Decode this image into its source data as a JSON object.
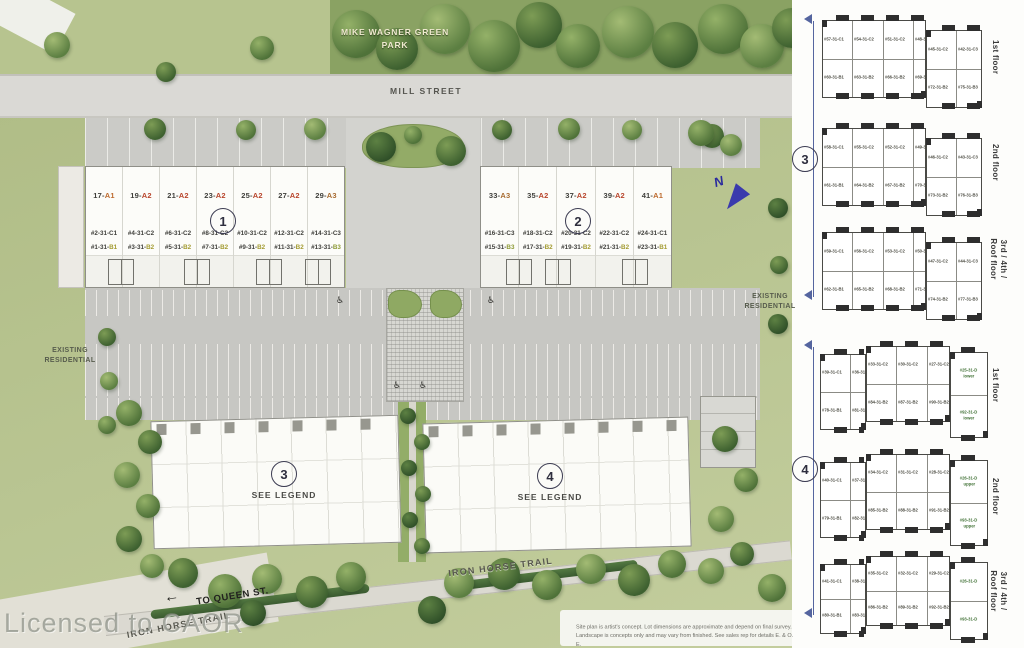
{
  "colors": {
    "site_green": "#b6c28d",
    "road_gray": "#dad9d5",
    "parking_gray": "#c7c7c3",
    "building_white": "#fcfcf9",
    "bracket_blue": "#55659f",
    "north_blue": "#3a3aad",
    "code_orange_a1": "#bd6a2e",
    "code_red_a2": "#b8452c",
    "code_brown_a3": "#a76b31",
    "code_olive_b": "#a39b31",
    "code_green_d": "#3f7034"
  },
  "site": {
    "park_label_1": "MIKE WAGNER GREEN",
    "park_label_2": "PARK",
    "street_label": "MILL STREET",
    "existing_left_1": "EXISTING",
    "existing_left_2": "RESIDENTIAL",
    "existing_right_1": "EXISTING",
    "existing_right_2": "RESIDENTIAL",
    "trail_label_1": "IRON HORSE TRAIL",
    "trail_label_2": "IRON HORSE TRAIL",
    "queen_arrow": "←",
    "queen_label": "TO QUEEN ST.",
    "north_label": "N",
    "watermark": "Licensed to CAOR",
    "see_legend_3": "SEE LEGEND",
    "see_legend_4": "SEE LEGEND",
    "wheelchair_icon": "♿",
    "disclaimer_1": "Site plan is artist's concept. Lot dimensions are approximate and depend on final survey.",
    "disclaimer_2": "Landscape is concepts only and may vary from finished. See sales rep for details E. & O. E.",
    "b1": {
      "num": "1",
      "units": [
        {
          "sn": "17-",
          "st": "A1",
          "sts": "color:#bd6a2e",
          "c1": "#2-31-C1",
          "c2a": "#1-31-",
          "c2b": "B1",
          "c2s": "color:#a39b31"
        },
        {
          "sn": "19-",
          "st": "A2",
          "sts": "color:#b8452c",
          "c1": "#4-31-C2",
          "c2a": "#3-31-",
          "c2b": "B2",
          "c2s": "color:#a39b31"
        },
        {
          "sn": "21-",
          "st": "A2",
          "sts": "color:#b8452c",
          "c1": "#6-31-C2",
          "c2a": "#5-31-",
          "c2b": "B2",
          "c2s": "color:#a39b31"
        },
        {
          "sn": "23-",
          "st": "A2",
          "sts": "color:#b8452c",
          "c1": "#8-31-C2",
          "c2a": "#7-31-",
          "c2b": "B2",
          "c2s": "color:#a39b31"
        },
        {
          "sn": "25-",
          "st": "A2",
          "sts": "color:#b8452c",
          "c1": "#10-31-C2",
          "c2a": "#9-31-",
          "c2b": "B2",
          "c2s": "color:#a39b31"
        },
        {
          "sn": "27-",
          "st": "A2",
          "sts": "color:#b8452c",
          "c1": "#12-31-C2",
          "c2a": "#11-31-",
          "c2b": "B2",
          "c2s": "color:#a39b31"
        },
        {
          "sn": "29-",
          "st": "A3",
          "sts": "color:#a76b31",
          "c1": "#14-31-C3",
          "c2a": "#13-31-",
          "c2b": "B3",
          "c2s": "color:#8d9a36"
        }
      ]
    },
    "b2": {
      "num": "2",
      "units": [
        {
          "sn": "33-",
          "st": "A3",
          "sts": "color:#a76b31",
          "c1": "#16-31-C3",
          "c2a": "#15-31-",
          "c2b": "B3",
          "c2s": "color:#8d9a36"
        },
        {
          "sn": "35-",
          "st": "A2",
          "sts": "color:#b8452c",
          "c1": "#18-31-C2",
          "c2a": "#17-31-",
          "c2b": "B2",
          "c2s": "color:#a39b31"
        },
        {
          "sn": "37-",
          "st": "A2",
          "sts": "color:#b8452c",
          "c1": "#20-31-C2",
          "c2a": "#19-31-",
          "c2b": "B2",
          "c2s": "color:#a39b31"
        },
        {
          "sn": "39-",
          "st": "A2",
          "sts": "color:#b8452c",
          "c1": "#22-31-C2",
          "c2a": "#21-31-",
          "c2b": "B2",
          "c2s": "color:#a39b31"
        },
        {
          "sn": "41-",
          "st": "A1",
          "sts": "color:#bd6a2e",
          "c1": "#24-31-C1",
          "c2a": "#23-31-",
          "c2b": "B1",
          "c2s": "color:#a39b31"
        }
      ]
    },
    "b3": {
      "num": "3"
    },
    "b4": {
      "num": "4"
    }
  },
  "legend": {
    "floors": [
      "1st floor",
      "2nd floor",
      "3rd / 4th / Roof floor"
    ],
    "g3": {
      "num": "3",
      "plans": [
        {
          "mt": [
            "#57-31-C1",
            "#54-31-C2",
            "#51-31-C2",
            "#48-31-C2"
          ],
          "mb": [
            "#60-31-B1",
            "#63-31-B2",
            "#66-31-B2",
            "#69-31-B2"
          ],
          "rt": [
            "#45-31-C2",
            "#42-31-C3"
          ],
          "rb": [
            "#72-31-B2",
            "#75-31-B3"
          ]
        },
        {
          "mt": [
            "#58-31-C1",
            "#55-31-C2",
            "#52-31-C2",
            "#49-31-C2"
          ],
          "mb": [
            "#61-31-B1",
            "#64-31-B2",
            "#67-31-B2",
            "#70-31-B2"
          ],
          "rt": [
            "#46-31-C2",
            "#43-31-C3"
          ],
          "rb": [
            "#73-31-B2",
            "#76-31-B3"
          ]
        },
        {
          "mt": [
            "#59-31-C1",
            "#56-31-C2",
            "#53-31-C2",
            "#50-31-C2"
          ],
          "mb": [
            "#62-31-B1",
            "#65-31-B2",
            "#68-31-B2",
            "#71-31-B2"
          ],
          "rt": [
            "#47-31-C2",
            "#44-31-C3"
          ],
          "rb": [
            "#74-31-B2",
            "#77-31-B3"
          ]
        }
      ]
    },
    "g4": {
      "num": "4",
      "plans": [
        {
          "lt": [
            "#39-31-C1",
            "#36-31-C2"
          ],
          "lb": [
            "#78-31-B1",
            "#81-31-B2"
          ],
          "mt": [
            "#33-31-C2",
            "#30-31-C2",
            "#27-31-C2"
          ],
          "mb": [
            "#84-31-B2",
            "#87-31-B2",
            "#90-31-B2"
          ],
          "rt": [
            {
              "t": "#25-31-D",
              "sub": "lower"
            }
          ],
          "rb": [
            {
              "t": "#92-31-D",
              "sub": "lower"
            }
          ]
        },
        {
          "lt": [
            "#40-31-C1",
            "#37-31-C2"
          ],
          "lb": [
            "#79-31-B1",
            "#82-31-B2"
          ],
          "mt": [
            "#34-31-C2",
            "#31-31-C2",
            "#28-31-C2"
          ],
          "mb": [
            "#85-31-B2",
            "#88-31-B2",
            "#91-31-B2"
          ],
          "rt": [
            {
              "t": "#26-31-D",
              "sub": "upper"
            }
          ],
          "rb": [
            {
              "t": "#93-31-D",
              "sub": "upper"
            }
          ]
        },
        {
          "lt": [
            "#41-31-C1",
            "#38-31-C2"
          ],
          "lb": [
            "#80-31-B1",
            "#83-31-B2"
          ],
          "mt": [
            "#35-31-C2",
            "#32-31-C2",
            "#29-31-C2"
          ],
          "mb": [
            "#86-31-B2",
            "#89-31-B2",
            "#92-31-B2"
          ],
          "rt": [
            {
              "t": "#26-31-D",
              "sub": ""
            }
          ],
          "rb": [
            {
              "t": "#93-31-D",
              "sub": ""
            }
          ]
        }
      ]
    }
  }
}
